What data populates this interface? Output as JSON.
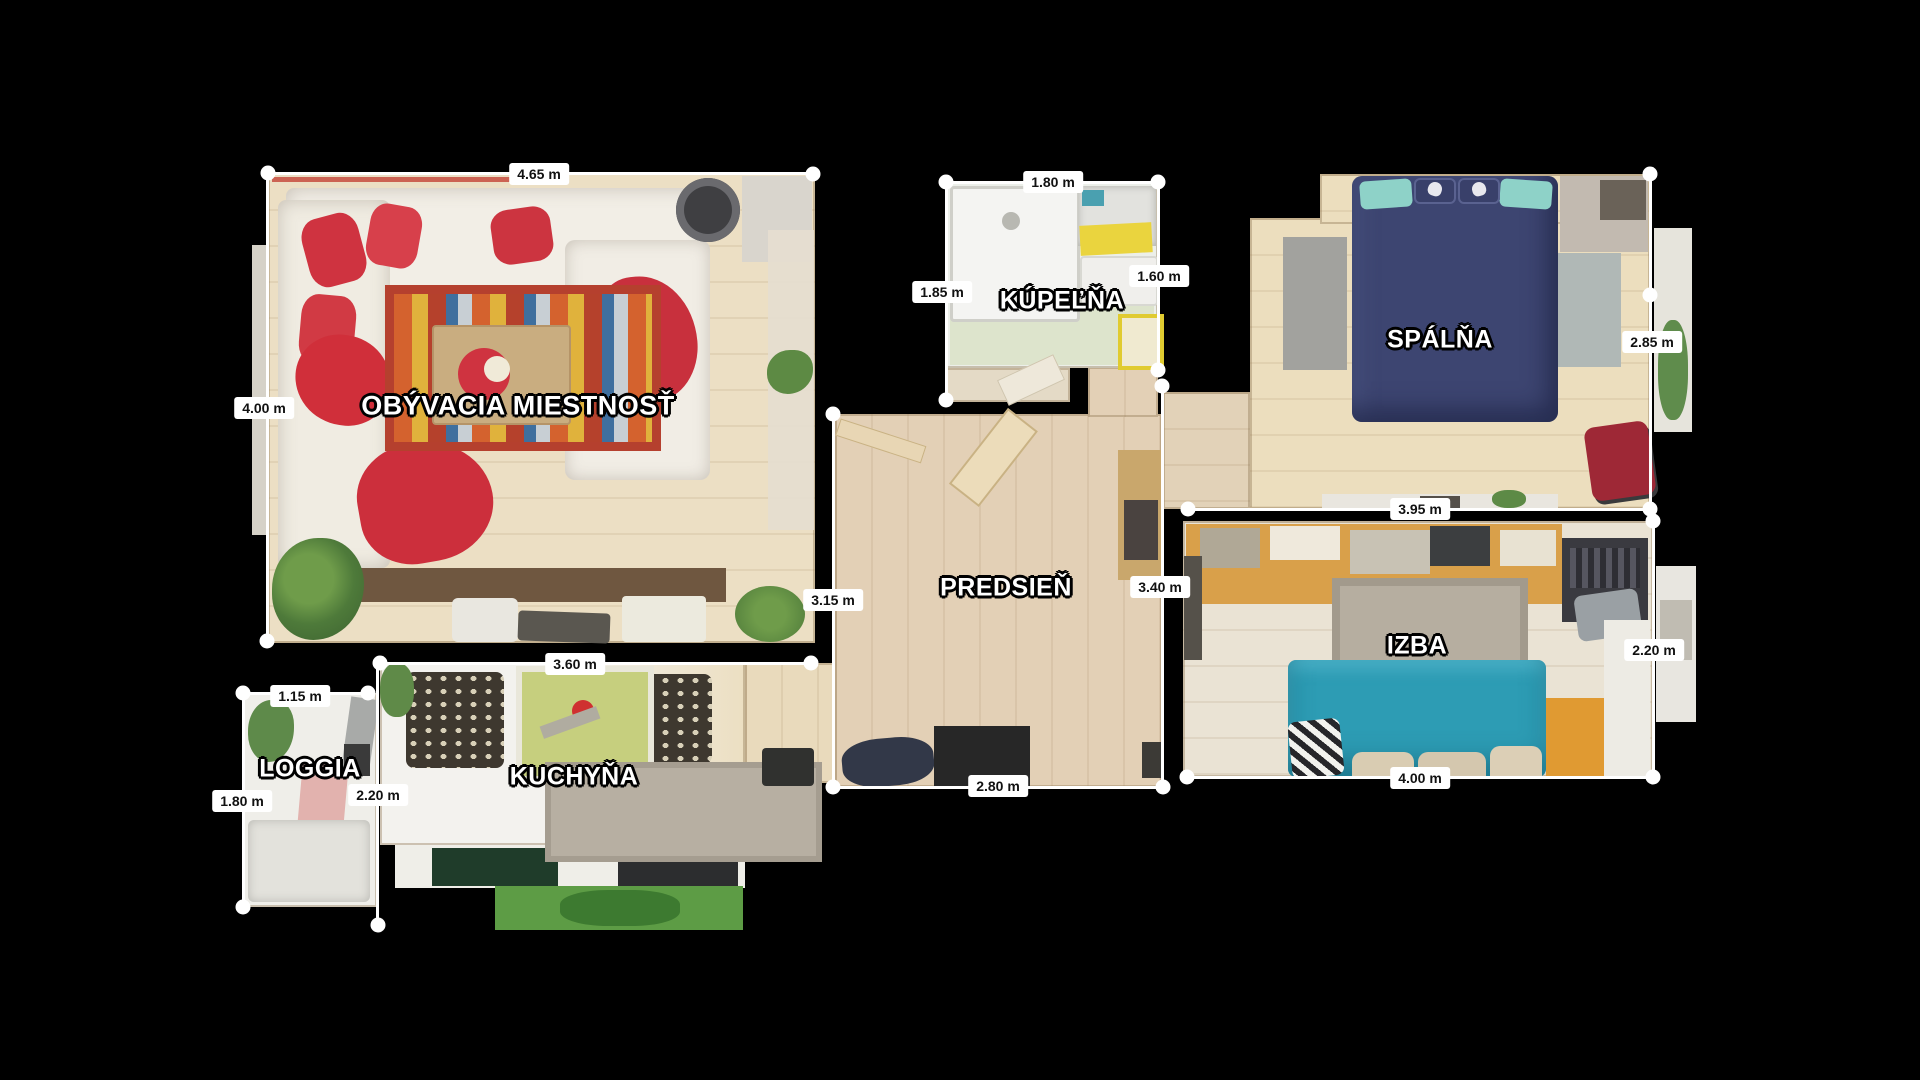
{
  "scene": {
    "type": "apartment-floor-plan",
    "background": "#000000",
    "unit": "m"
  },
  "rooms": {
    "living": {
      "name": "OBÝVACIA MIESTNOSŤ",
      "dims": [
        "4.65 m",
        "4.00 m"
      ]
    },
    "kitchen": {
      "name": "KUCHYŇA",
      "dims": [
        "3.60 m"
      ]
    },
    "loggia": {
      "name": "LOGGIA",
      "dims": [
        "1.15 m",
        "1.80 m",
        "2.20 m"
      ]
    },
    "hall": {
      "name": "PREDSIEŇ",
      "dims": [
        "3.15 m",
        "3.40 m",
        "2.80 m"
      ]
    },
    "bath": {
      "name": "KÚPEĽŇA",
      "dims": [
        "1.80 m",
        "1.85 m",
        "1.60 m"
      ]
    },
    "bedroom": {
      "name": "SPÁLŇA",
      "dims": [
        "2.85 m",
        "3.95 m"
      ]
    },
    "room": {
      "name": "IZBA",
      "dims": [
        "2.20 m",
        "4.00 m"
      ]
    }
  },
  "dims": {
    "living_top": {
      "text": "4.65 m"
    },
    "living_left": {
      "text": "4.00 m"
    },
    "hall_left": {
      "text": "3.15 m"
    },
    "hall_right": {
      "text": "3.40 m"
    },
    "hall_bottom": {
      "text": "2.80 m"
    },
    "bath_top": {
      "text": "1.80 m"
    },
    "bath_left": {
      "text": "1.85 m"
    },
    "bath_right": {
      "text": "1.60 m"
    },
    "bedroom_right": {
      "text": "2.85 m"
    },
    "bedroom_bottom": {
      "text": "3.95 m"
    },
    "room_right": {
      "text": "2.20 m"
    },
    "room_bottom": {
      "text": "4.00 m"
    },
    "loggia_top": {
      "text": "1.15 m"
    },
    "loggia_left": {
      "text": "1.80 m"
    },
    "loggia_right": {
      "text": "2.20 m"
    },
    "kitchen_top": {
      "text": "3.60 m"
    }
  },
  "colors": {
    "measure_line": "#ffffff",
    "dim_text": "#111111",
    "wood_light": "#ecdfc6",
    "bed_navy": "#3d4571",
    "sofa_teal": "#2d9cb4",
    "accent_red": "#cf3340",
    "accent_orange": "#e09a32",
    "kitchen_table_green": "#c6cf7e",
    "mat_green": "#5d9c45"
  }
}
